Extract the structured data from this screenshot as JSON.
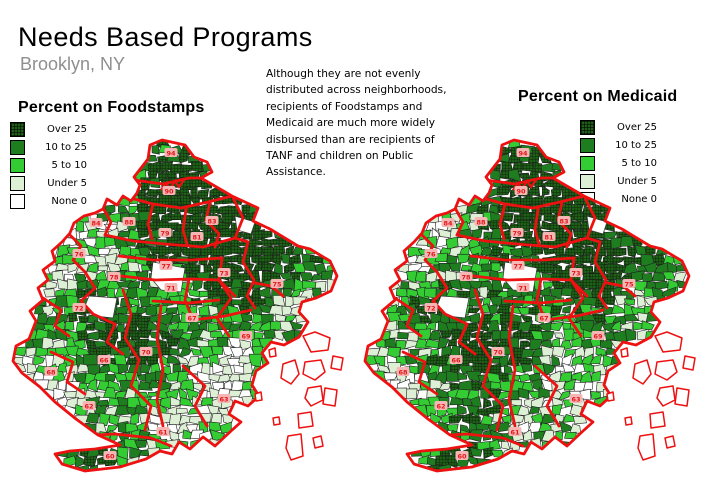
{
  "page": {
    "title": "Needs Based Programs",
    "subtitle": "Brooklyn, NY"
  },
  "description": {
    "text": "Although they are not evenly\ndistributed across neighborhoods,\nrecipients of Foodstamps and\nMedicaid are much more widely\ndisbursed than are recipients of\nTANF and children on Public\nAssistance."
  },
  "legend": {
    "items": [
      {
        "label": "Over 25",
        "color": "#1e6018",
        "hatch": true
      },
      {
        "label": "10 to 25",
        "color": "#1e7d1e",
        "hatch": false
      },
      {
        "label": "5 to 10",
        "color": "#33cc33",
        "hatch": false
      },
      {
        "label": "Under 5",
        "color": "#ddefd5",
        "hatch": false
      },
      {
        "label": "None 0",
        "color": "#ffffff",
        "hatch": false
      }
    ]
  },
  "maps": [
    {
      "id": "foodstamps",
      "title": "Percent on Foodstamps",
      "seed": 421,
      "south_boost": 0
    },
    {
      "id": "medicaid",
      "title": "Percent on Medicaid",
      "seed": 977,
      "south_boost": 0.1
    }
  ],
  "colors": {
    "district_boundary": "#ee1111",
    "tract_border": "#222222",
    "hatch_line": "#0c2a08",
    "park_fill": "#ffffff",
    "island_fill": "#ffffff",
    "precinct_chip_bg": "#f7b6b6",
    "precinct_chip_text": "#e01818"
  },
  "precincts": [
    {
      "label": "94",
      "x": 168,
      "y": 15
    },
    {
      "label": "90",
      "x": 166,
      "y": 53
    },
    {
      "label": "84",
      "x": 93,
      "y": 85
    },
    {
      "label": "88",
      "x": 126,
      "y": 84
    },
    {
      "label": "79",
      "x": 162,
      "y": 95
    },
    {
      "label": "81",
      "x": 194,
      "y": 99
    },
    {
      "label": "83",
      "x": 209,
      "y": 83
    },
    {
      "label": "75",
      "x": 274,
      "y": 146
    },
    {
      "label": "77",
      "x": 163,
      "y": 128
    },
    {
      "label": "73",
      "x": 221,
      "y": 135
    },
    {
      "label": "71",
      "x": 168,
      "y": 150
    },
    {
      "label": "76",
      "x": 76,
      "y": 116
    },
    {
      "label": "78",
      "x": 111,
      "y": 139
    },
    {
      "label": "72",
      "x": 76,
      "y": 170
    },
    {
      "label": "67",
      "x": 189,
      "y": 180
    },
    {
      "label": "69",
      "x": 243,
      "y": 198
    },
    {
      "label": "70",
      "x": 143,
      "y": 214
    },
    {
      "label": "66",
      "x": 101,
      "y": 222
    },
    {
      "label": "68",
      "x": 48,
      "y": 234
    },
    {
      "label": "62",
      "x": 86,
      "y": 268
    },
    {
      "label": "61",
      "x": 160,
      "y": 294
    },
    {
      "label": "60",
      "x": 107,
      "y": 318
    },
    {
      "label": "63",
      "x": 221,
      "y": 261
    }
  ],
  "density_regions": [
    {
      "name": "greenpoint",
      "x": 160,
      "y": 22,
      "s": 13,
      "w": 0.18
    },
    {
      "name": "williamsburg",
      "x": 168,
      "y": 55,
      "s": 26,
      "w": 0.34
    },
    {
      "name": "bedford-stuyvesant",
      "x": 186,
      "y": 90,
      "s": 30,
      "w": 0.42
    },
    {
      "name": "bushwick",
      "x": 224,
      "y": 84,
      "s": 22,
      "w": 0.4
    },
    {
      "name": "brownsville",
      "x": 222,
      "y": 133,
      "s": 19,
      "w": 0.4
    },
    {
      "name": "east-new-york",
      "x": 262,
      "y": 124,
      "s": 27,
      "w": 0.36
    },
    {
      "name": "sunset-park",
      "x": 82,
      "y": 168,
      "s": 15,
      "w": 0.26
    },
    {
      "name": "borough-park",
      "x": 108,
      "y": 203,
      "s": 20,
      "w": 0.28
    },
    {
      "name": "flatbush",
      "x": 152,
      "y": 203,
      "s": 21,
      "w": 0.26
    },
    {
      "name": "coney-island",
      "x": 100,
      "y": 318,
      "s": 13,
      "w": 0.38
    },
    {
      "name": "canarsie",
      "x": 240,
      "y": 185,
      "s": 16,
      "w": 0.1
    },
    {
      "name": "bay-ridge",
      "x": 42,
      "y": 238,
      "s": 25,
      "w": -0.34
    },
    {
      "name": "park-slope-heights",
      "x": 88,
      "y": 98,
      "s": 21,
      "w": -0.3
    },
    {
      "name": "red-hook-carroll",
      "x": 56,
      "y": 133,
      "s": 15,
      "w": -0.26
    },
    {
      "name": "flatlands-mill-basin",
      "x": 226,
      "y": 242,
      "s": 32,
      "w": -0.4
    },
    {
      "name": "sheepshead-bay",
      "x": 172,
      "y": 292,
      "s": 22,
      "w": -0.26
    },
    {
      "name": "bensonhurst-coast",
      "x": 62,
      "y": 288,
      "s": 17,
      "w": -0.22
    },
    {
      "name": "starrett-city",
      "x": 282,
      "y": 168,
      "s": 13,
      "w": -0.3
    },
    {
      "name": "dyker-heights",
      "x": 60,
      "y": 260,
      "s": 14,
      "w": -0.18
    }
  ]
}
